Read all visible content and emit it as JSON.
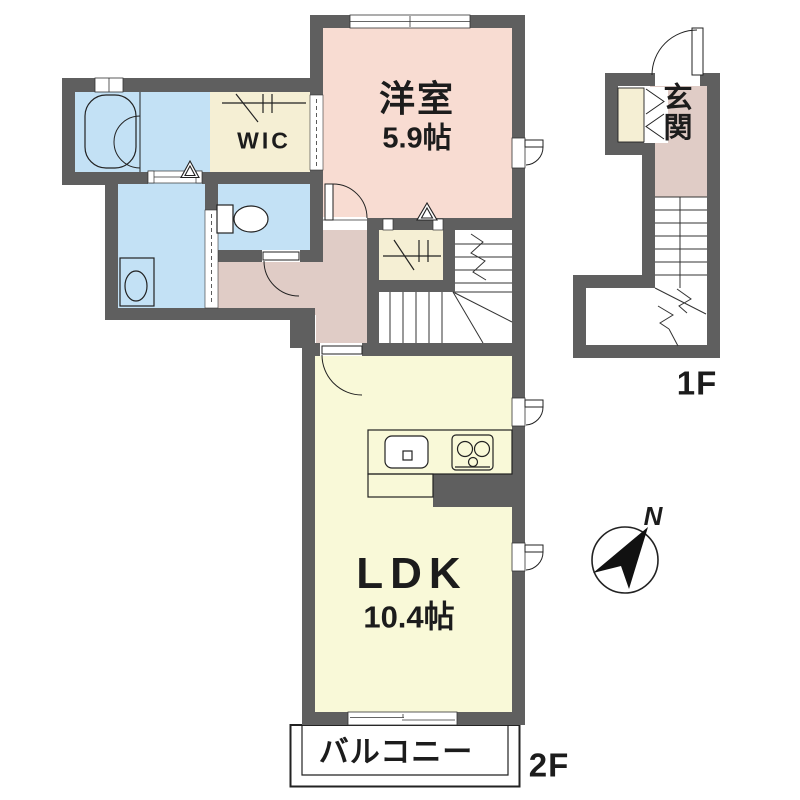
{
  "plan": {
    "rooms": {
      "western_room": {
        "name": "洋室",
        "size": "5.9帖"
      },
      "wic": {
        "name": "WIC"
      },
      "ldk": {
        "name": "LDK",
        "size": "10.4帖"
      },
      "balcony": {
        "name": "バルコニー"
      },
      "entrance": {
        "name": "玄関"
      }
    },
    "floor_labels": {
      "first": "1F",
      "second": "2F"
    },
    "compass": {
      "north": "N"
    },
    "colors": {
      "wall": "#5f5f5f",
      "western_room": "#f8dcd2",
      "hallway": "#e0ccc6",
      "wet_area": "#c3e1f5",
      "ldk": "#f9f9d8",
      "closet": "#f5efd4",
      "balcony": "#ffffff",
      "outline": "#222222"
    }
  }
}
